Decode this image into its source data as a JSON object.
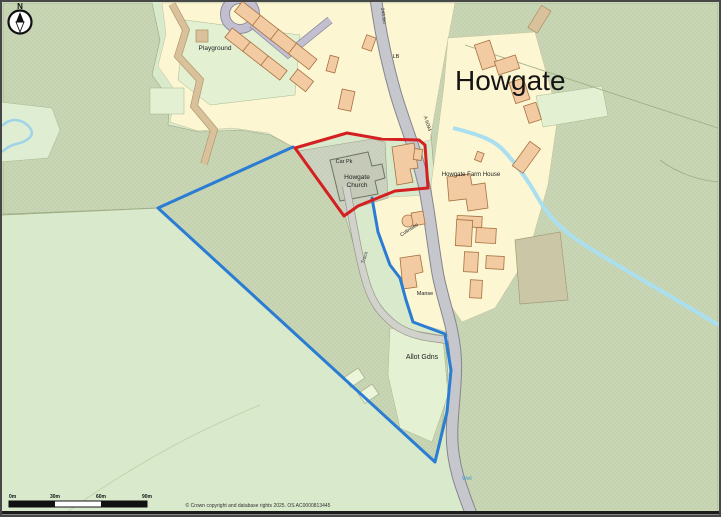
{
  "map": {
    "title": "Howgate",
    "labels": {
      "playground": "Playground",
      "car_park": "Car Pk",
      "church_line1": "Howgate",
      "church_line2": "Church",
      "farm_house": "Howgate Farm House",
      "colinslee": "Colinslee",
      "manse": "Manse",
      "allotments": "Allot Gdns",
      "well": "Well",
      "track": "Track",
      "road_name": "A 6094",
      "letter_box": "LB",
      "spot_height": "243.9m"
    },
    "compass": {
      "north": "N"
    },
    "scale_bar": {
      "ticks": [
        "0m",
        "30m",
        "60m",
        "90m"
      ]
    },
    "copyright": "© Crown copyright and database rights 2025. OS AC0000813445",
    "colors": {
      "red_boundary": "#d42020",
      "blue_boundary": "#2b7cd3",
      "field_light": "#d9e9cb",
      "field_rough": "#c9d6b5",
      "plot_cream": "#fcf6d3",
      "building_orange": "#f2cba3",
      "road_gray": "#c6c6cd",
      "water": "#aadff0"
    }
  }
}
